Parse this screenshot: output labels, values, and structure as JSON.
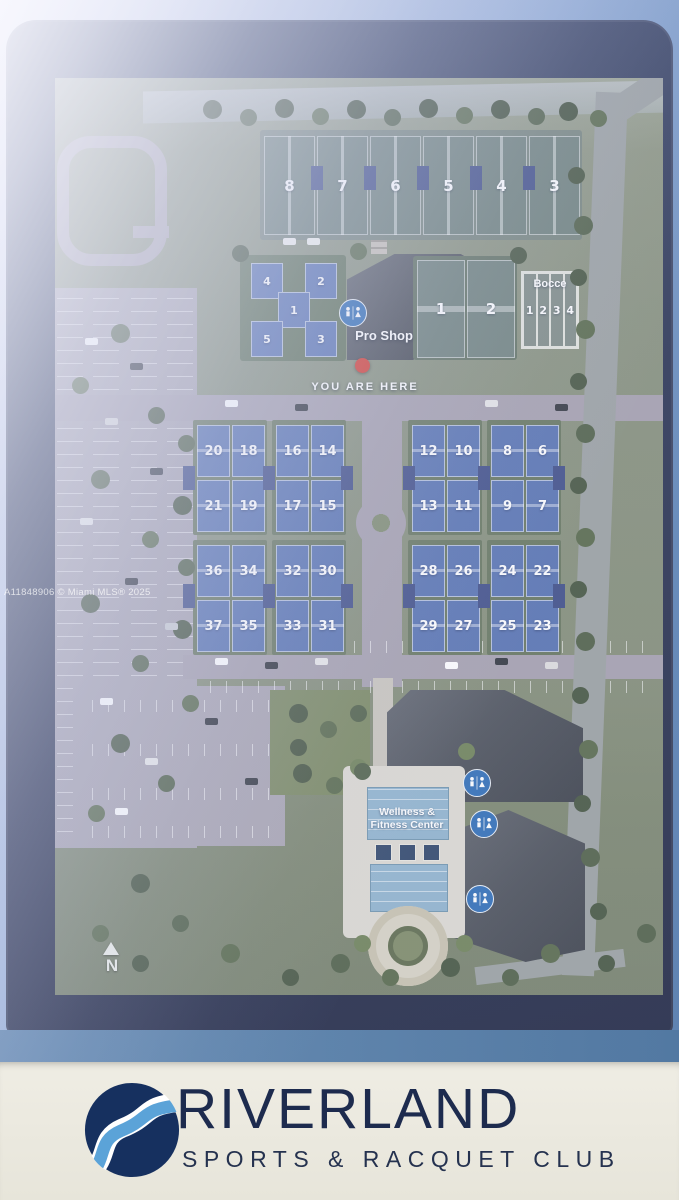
{
  "colors": {
    "frame_navy": "#2a3454",
    "strip_blue": "#4a769f",
    "panel_cream": "#eceae0",
    "logo_navy": "#1c2b4e",
    "logo_blue": "#5ba3d8",
    "pickleball_blue": "#5571b0",
    "red_marker": "#d23b30",
    "restroom_blue": "#2f6db5"
  },
  "watermark": "A11848906 © Miami MLS® 2025",
  "map": {
    "north_label": "N",
    "pro_shop_label": "Pro Shop",
    "you_are_here_label": "YOU ARE HERE",
    "wellness_line1": "Wellness &",
    "wellness_line2": "Fitness Center",
    "tennis_top": [
      "8",
      "7",
      "6",
      "5",
      "4",
      "3"
    ],
    "stadium_courts": [
      "4",
      "2",
      "1",
      "5",
      "3"
    ],
    "tennis_right": [
      "1",
      "2"
    ],
    "bocce": {
      "title": "Bocce",
      "lanes": [
        "1",
        "2",
        "3",
        "4"
      ]
    },
    "grid_pads": [
      {
        "courts": [
          "20",
          "18",
          "21",
          "19"
        ]
      },
      {
        "courts": [
          "16",
          "14",
          "17",
          "15"
        ]
      },
      {
        "courts": [
          "12",
          "10",
          "13",
          "11"
        ]
      },
      {
        "courts": [
          "8",
          "6",
          "9",
          "7"
        ]
      },
      {
        "courts": [
          "36",
          "34",
          "37",
          "35"
        ]
      },
      {
        "courts": [
          "32",
          "30",
          "33",
          "31"
        ]
      },
      {
        "courts": [
          "28",
          "26",
          "29",
          "27"
        ]
      },
      {
        "courts": [
          "24",
          "22",
          "25",
          "23"
        ]
      }
    ]
  },
  "logo": {
    "name": "RIVERLAND",
    "tagline": "SPORTS & RACQUET CLUB"
  }
}
